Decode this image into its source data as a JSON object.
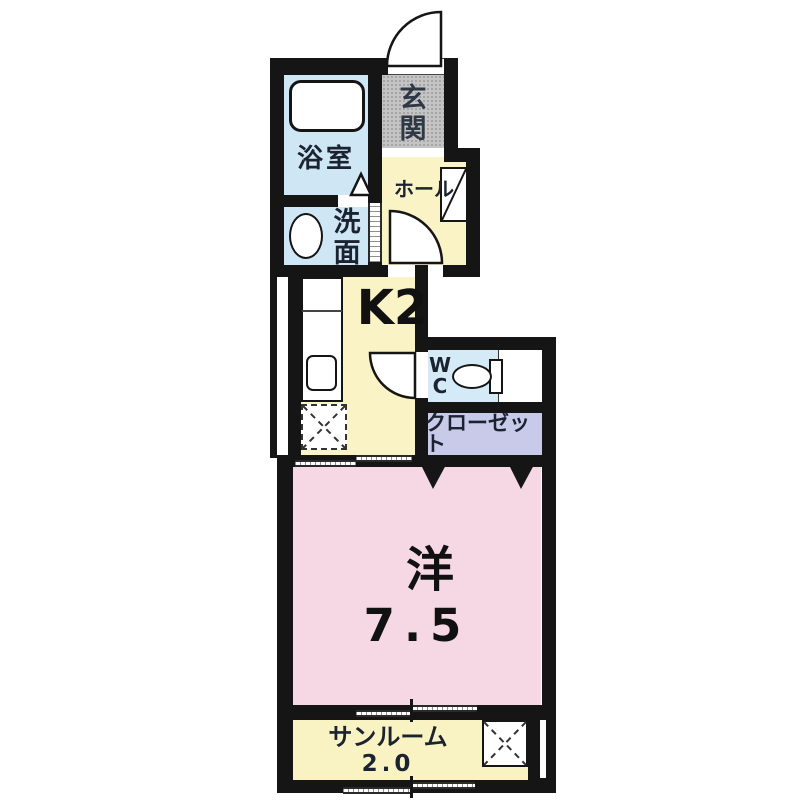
{
  "plan_title": "1K apartment floor plan",
  "colors": {
    "wall": "#151515",
    "water_blue": "#cfe6f4",
    "wc_blue": "#d4ebf7",
    "yellow": "#f9f3c6",
    "sunroom_yellow": "#f9f2c2",
    "gray": "#c4c4c4",
    "lavender": "#c9c9e9",
    "pink": "#f5d8e3",
    "text": "#1b2230"
  },
  "rooms": {
    "bath": {
      "label": "浴室"
    },
    "washroom": {
      "chars": [
        "洗",
        "面"
      ]
    },
    "entrance": {
      "chars": [
        "玄",
        "関"
      ]
    },
    "hall": {
      "label": "ホール"
    },
    "kitchen": {
      "label": "K2"
    },
    "toilet": {
      "chars": [
        "W",
        "C"
      ]
    },
    "closet": {
      "label": "クローゼット"
    },
    "western_room": {
      "label": "洋",
      "size": "7.5"
    },
    "sunroom": {
      "label": "サンルーム",
      "size": "2.0"
    }
  }
}
